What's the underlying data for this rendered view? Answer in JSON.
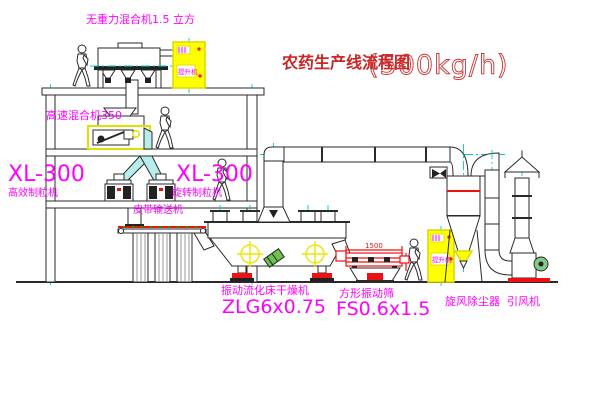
{
  "title": {
    "text": "农药生产线流程图",
    "capacity": "(500kg/h)"
  },
  "labels": {
    "gravity_mixer": "无重力混合机1.5 立方",
    "high_speed_mixer": "高速混合机350",
    "xl300_left": "XL-300",
    "xl300_left_sub": "高效制粒机",
    "xl300_mid": "XL-300",
    "xl300_mid_sub": "旋转制粒机",
    "belt_conveyor": "皮带输送机",
    "dryer": "振动流化床干燥机",
    "dryer_model": "ZLG6x0.75",
    "screen": "方形振动筛",
    "screen_model": "FS0.6x1.5",
    "cyclone": "旋风除尘器",
    "fan": "引风机",
    "elevator": "提升机"
  },
  "dimensions": {
    "screen_width": "1500"
  },
  "colors": {
    "label_magenta": "#ff00ff",
    "title_red": "#cc2626",
    "dimension_red": "#ee1111",
    "machine_yellow": "#ffff00",
    "centerline_cyan": "#00cccc",
    "line_dark": "#2a2a2a",
    "motor_green": "#55aa44"
  }
}
